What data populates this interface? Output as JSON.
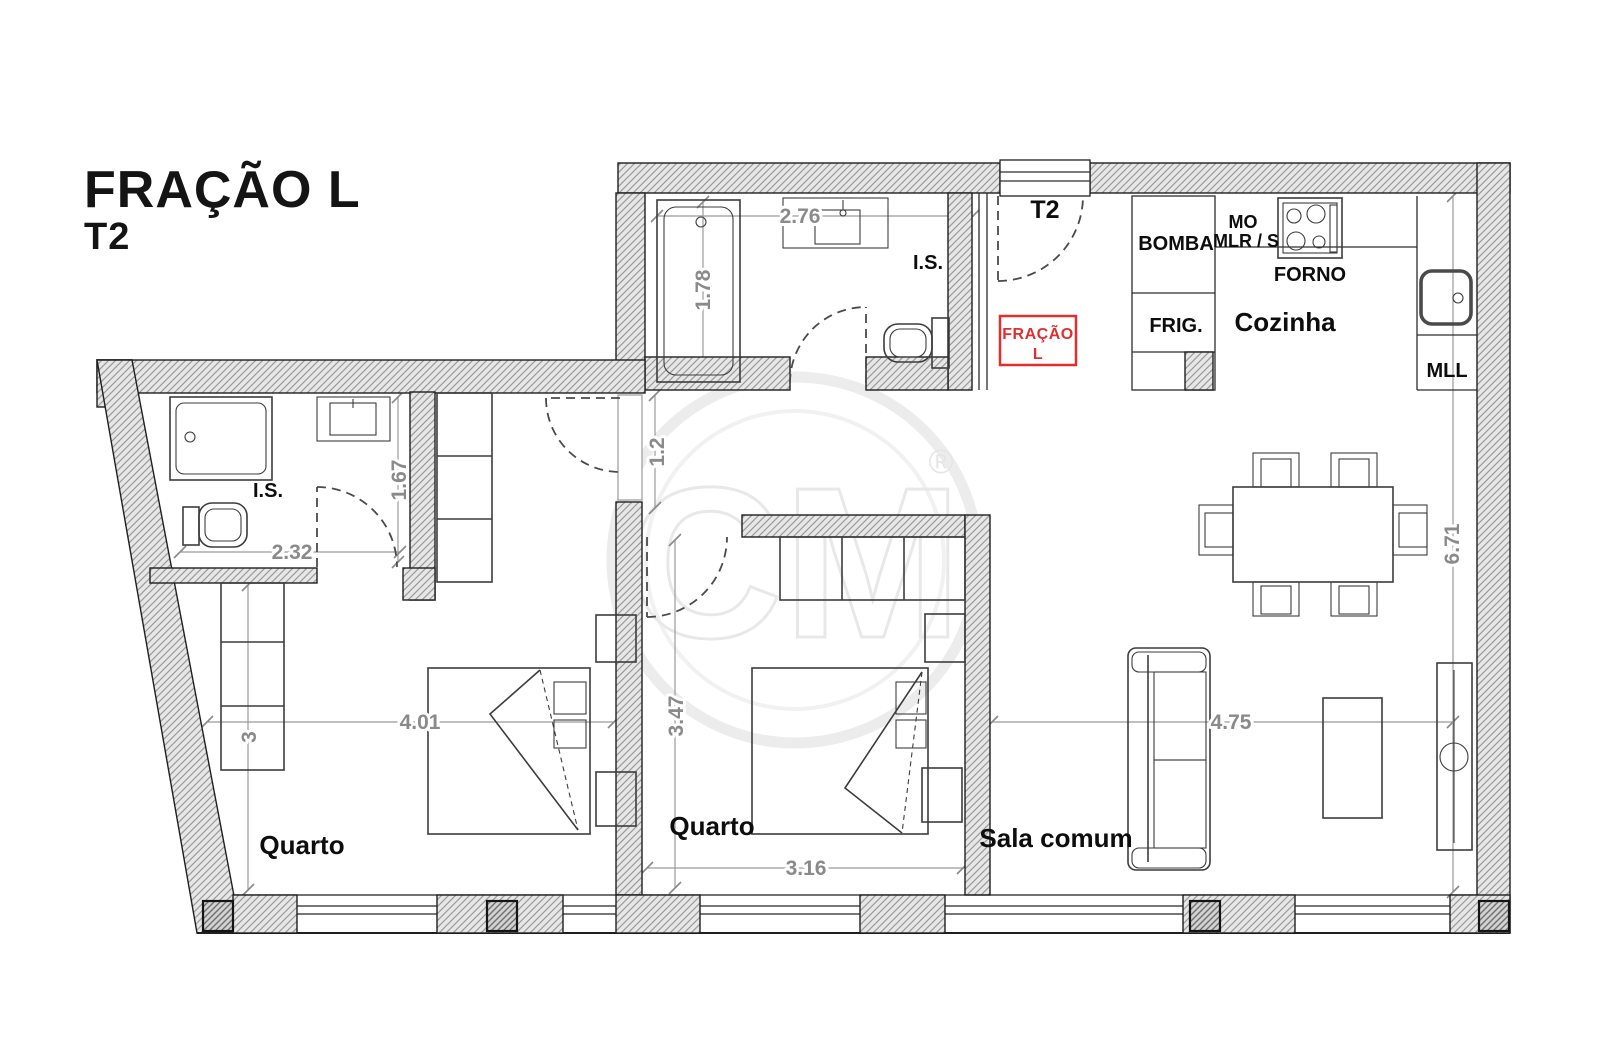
{
  "title": {
    "line1": "FRAÇÃO L",
    "line2": "T2"
  },
  "entrance": {
    "label": "T2"
  },
  "tag": {
    "line1": "FRAÇÃO",
    "line2": "L"
  },
  "rooms": {
    "bathroom_top": {
      "label": "I.S."
    },
    "bathroom_left": {
      "label": "I.S."
    },
    "bedroom_left": {
      "label": "Quarto"
    },
    "bedroom_middle": {
      "label": "Quarto"
    },
    "living": {
      "label": "Sala comum"
    },
    "kitchen": {
      "label": "Cozinha"
    }
  },
  "kitchen": {
    "bomba": "BOMBA",
    "mo": "MO",
    "mlrs": "MLR / S",
    "forno": "FORNO",
    "frig": "FRIG.",
    "mll": "MLL"
  },
  "dims": {
    "bath_top_w": "2.76",
    "bath_top_h": "1.78",
    "hall_h": "1.2",
    "bath_left_h": "1.67",
    "bath_left_w": "2.32",
    "bedroom_left_h": "3",
    "bedroom_left_w": "4.01",
    "bedroom_mid_h": "3.47",
    "bedroom_mid_w": "3.16",
    "living_w": "4.75",
    "living_h": "6.71"
  },
  "watermark": {
    "text": "CM",
    "registered": "®"
  },
  "colors": {
    "accent_red": "#e02f2f",
    "dimension_gray": "#8a8a8a",
    "wall_hatch": "#9c9c9c",
    "ink": "#1f1f1f"
  }
}
